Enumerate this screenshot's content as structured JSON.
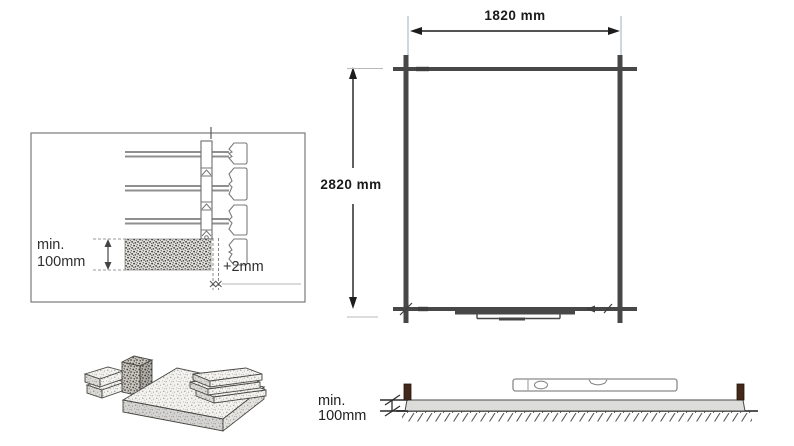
{
  "page": {
    "background": "#ffffff"
  },
  "plan": {
    "width_dim": "1820 mm",
    "height_dim": "2820 mm",
    "wall_color": "#474747",
    "dim_text_color": "#1a1a1a",
    "extension_line_color": "#a9bcce"
  },
  "wall_detail": {
    "min_height_line1": "min.",
    "min_height_line2": "100mm",
    "gap_tolerance": "+2mm",
    "text_color": "#2f2f2f"
  },
  "side_view": {
    "min_height_line1": "min.",
    "min_height_line2": "100mm",
    "slab_color": "#dcdcda",
    "post_color": "#44291a",
    "text_color": "#1f1f1f"
  }
}
